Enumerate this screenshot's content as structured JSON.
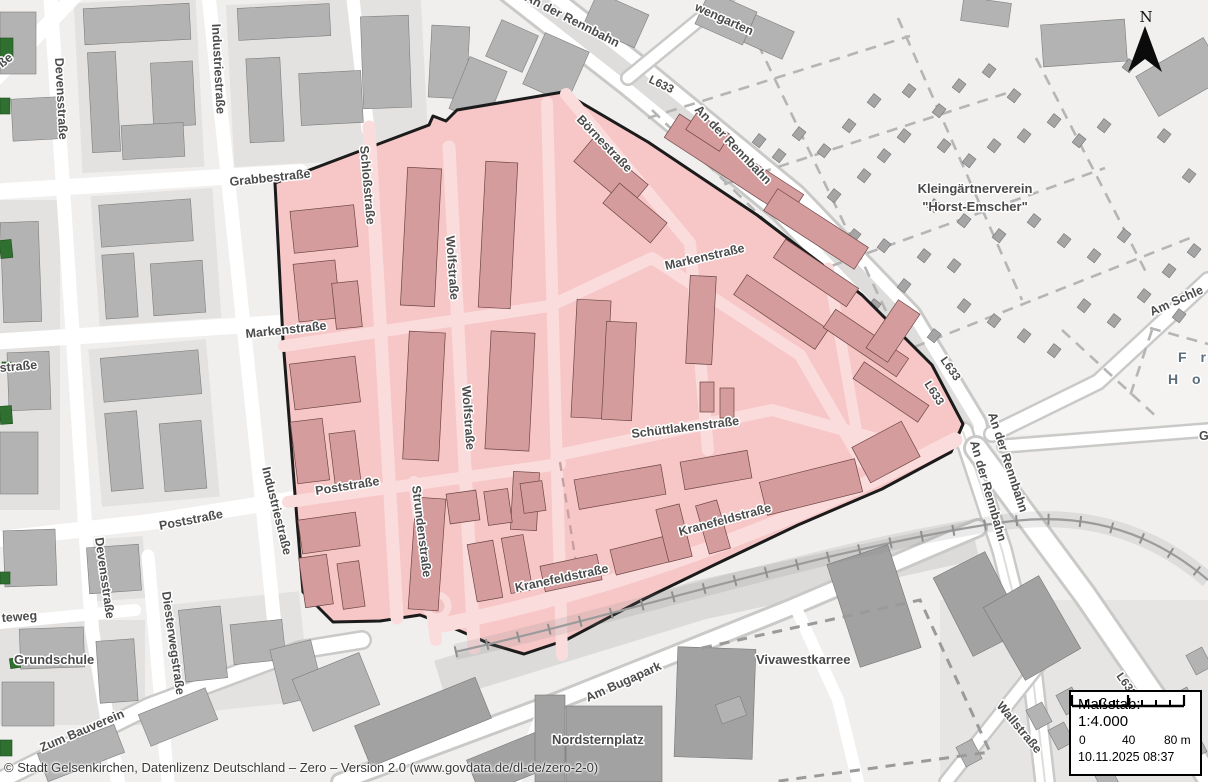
{
  "map": {
    "labels": {
      "devensstrasse_n": "Devensstraße",
      "devensstrasse_s": "Devensstraße",
      "industriestrasse_n": "Industriestraße",
      "industriestrasse_s": "Industriestraße",
      "grabbestrasse": "Grabbestraße",
      "markenstrasse_w": "Markenstraße",
      "markenstrasse_inner": "Markenstraße",
      "poststrasse_w": "Poststraße",
      "poststrasse_inner": "Poststraße",
      "diesterwegstrasse": "Diesterwegstraße",
      "zum_bauverein": "Zum Bauverein",
      "grundschule": "Grundschule",
      "teweg": "teweg",
      "strasse_edge": "straße",
      "sse_corner": "ße",
      "schlossstrasse": "Schloßstraße",
      "wolfstrasse_n": "Wolfstraße",
      "wolfstrasse_s": "Wolfstraße",
      "boernestrasse": "Börnestraße",
      "schuettlakenstrasse": "Schüttlakenstraße",
      "strundenstrasse": "Strundenstraße",
      "kranefeldstrasse_w": "Kranefeldstraße",
      "kranefeldstrasse_e": "Kranefeldstraße",
      "an_der_rennbahn_top": "An der Rennbahn",
      "an_der_rennbahn_ne": "An der Rennbahn",
      "an_der_rennbahn_e1": "An der Rennbahn",
      "an_der_rennbahn_e2": "An der Rennbahn",
      "l633_top": "L633",
      "l633_mid1": "L633",
      "l633_mid2": "L633",
      "l633_s": "L633",
      "am_schle": "Am Schle",
      "fr": "F r",
      "hor": "H o r",
      "g_edge": "G",
      "wengarten": "wengarten",
      "kleingarten_1": "Kleingärtnerverein",
      "kleingarten_2": "\"Horst-Emscher\"",
      "am_bugapark": "Am Bugapark",
      "nordsternplatz": "Nordsternplatz",
      "vivawestkarree": "Vivawestkarree",
      "wallstrasse": "Wallstraße"
    }
  },
  "north_indicator": {
    "label": "N"
  },
  "scale_panel": {
    "scale_label": "Maßstab: 1:4.000",
    "bar_ticks": [
      "0",
      "40",
      "80 m"
    ],
    "timestamp": "10.11.2025 08:37"
  },
  "attribution": {
    "text": "© Stadt Gelsenkirchen, Datenlizenz Deutschland – Zero – Version 2.0 (www.govdata.de/dl-de/zero-2-0)"
  },
  "colors": {
    "selection_fill": "#f7c7c7",
    "selection_building": "#d49c9c",
    "selection_border": "#1b1b1b",
    "building_gray": "#b3b3b3",
    "road_white": "#ffffff",
    "label_gray": "#4c4c4c",
    "marker_green": "#2f6f2f"
  }
}
